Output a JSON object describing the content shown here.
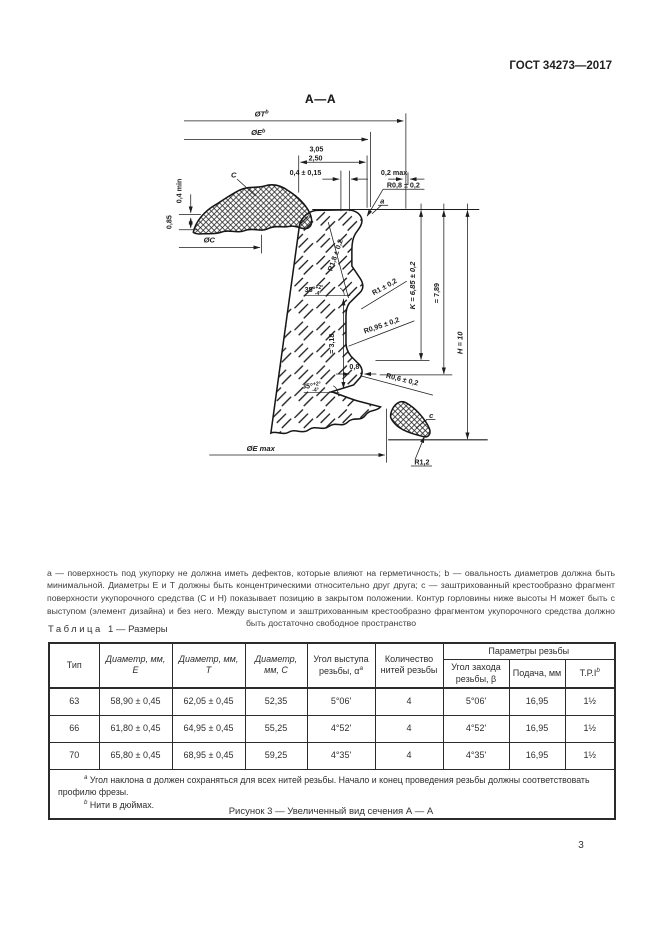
{
  "page": {
    "standard_code": "ГОСТ 34273—2017",
    "page_number": "3"
  },
  "figure": {
    "section_title": "А—А",
    "caption": "Рисунок 3 — Увеличенный вид сечения А — А",
    "footnote": "a — поверхность под укупорку не должна иметь дефектов, которые влияют на герметичность; b — овальность диаметров должна быть минимальной. Диаметры Е и Т должны быть концентрическими относительно друг друга; c — заштрихованный крестообразно фрагмент поверхности укупорочного средства (С и Н) показывает позицию в закрытом положении. Контур горловины ниже высоты Н может быть с выступом (элемент дизайна) и без него. Между выступом и заштрихованным крестообразно фрагментом укупорочного средства должно быть достаточно свободное пространство",
    "labels": {
      "dia_t": "ØT",
      "dia_t_sup": "b",
      "dia_e": "ØE",
      "dia_e_sup": "b",
      "dim_305": "3,05",
      "dim_250": "2,50",
      "dim_04_015": "0,4 ± 0,15",
      "dim_02_max": "0,2 max",
      "r08": "R0,8 ± 0,2",
      "surface_a": "a",
      "cap_c": "C",
      "dim_04_min": "0,4 min",
      "dim_085": "0,85",
      "dia_c": "ØC",
      "r18": "R1,8 ± 0,2",
      "angle1": "35°",
      "angle1_sup": "+2°",
      "angle1_sub": "-4°",
      "angle2": "35°",
      "angle2_sup": "+2°",
      "angle2_sub": "-4°",
      "dim_318": "= 3,18",
      "r1": "R1 ± 0,2",
      "r095": "R0,95 ± 0,2",
      "dim_08": "0,8",
      "r06": "R0,6 ± 0,2",
      "dim_k": "K = 6,85 ± 0,2",
      "dim_789": "= 7,89",
      "dim_h": "H = 10",
      "dia_e_max": "ØE max",
      "bead_c": "c",
      "r12": "R1,2"
    }
  },
  "table": {
    "title_word": "Таблица",
    "title_rest": "1 — Размеры",
    "headers": {
      "tip": "Тип",
      "dia_e": "Диаметр, мм, E",
      "dia_t": "Диаметр, мм, T",
      "dia_c": "Диаметр, мм, C",
      "lead_angle": "Угол выступа резьбы, α",
      "lead_angle_sup": "a",
      "thread_count": "Количество нитей резьбы",
      "thread_params": "Параметры резьбы",
      "start_angle": "Угол захода резьбы, β",
      "pitch": "Подача, мм",
      "tpi": "T.P.I",
      "tpi_sup": "b"
    },
    "rows": [
      [
        "63",
        "58,90 ± 0,45",
        "62,05 ± 0,45",
        "52,35",
        "5°06'",
        "4",
        "5°06'",
        "16,95",
        "1½"
      ],
      [
        "66",
        "61,80 ± 0,45",
        "64,95 ± 0,45",
        "55,25",
        "4°52'",
        "4",
        "4°52'",
        "16,95",
        "1½"
      ],
      [
        "70",
        "65,80 ± 0,45",
        "68,95 ± 0,45",
        "59,25",
        "4°35'",
        "4",
        "4°35'",
        "16,95",
        "1½"
      ]
    ],
    "footnotes": [
      {
        "sup": "a",
        "text": "Угол наклона α должен сохраняться для всех нитей резьбы. Начало и конец проведения резьбы должны соответствовать профилю фрезы."
      },
      {
        "sup": "b",
        "text": "Нити в дюймах."
      }
    ]
  }
}
